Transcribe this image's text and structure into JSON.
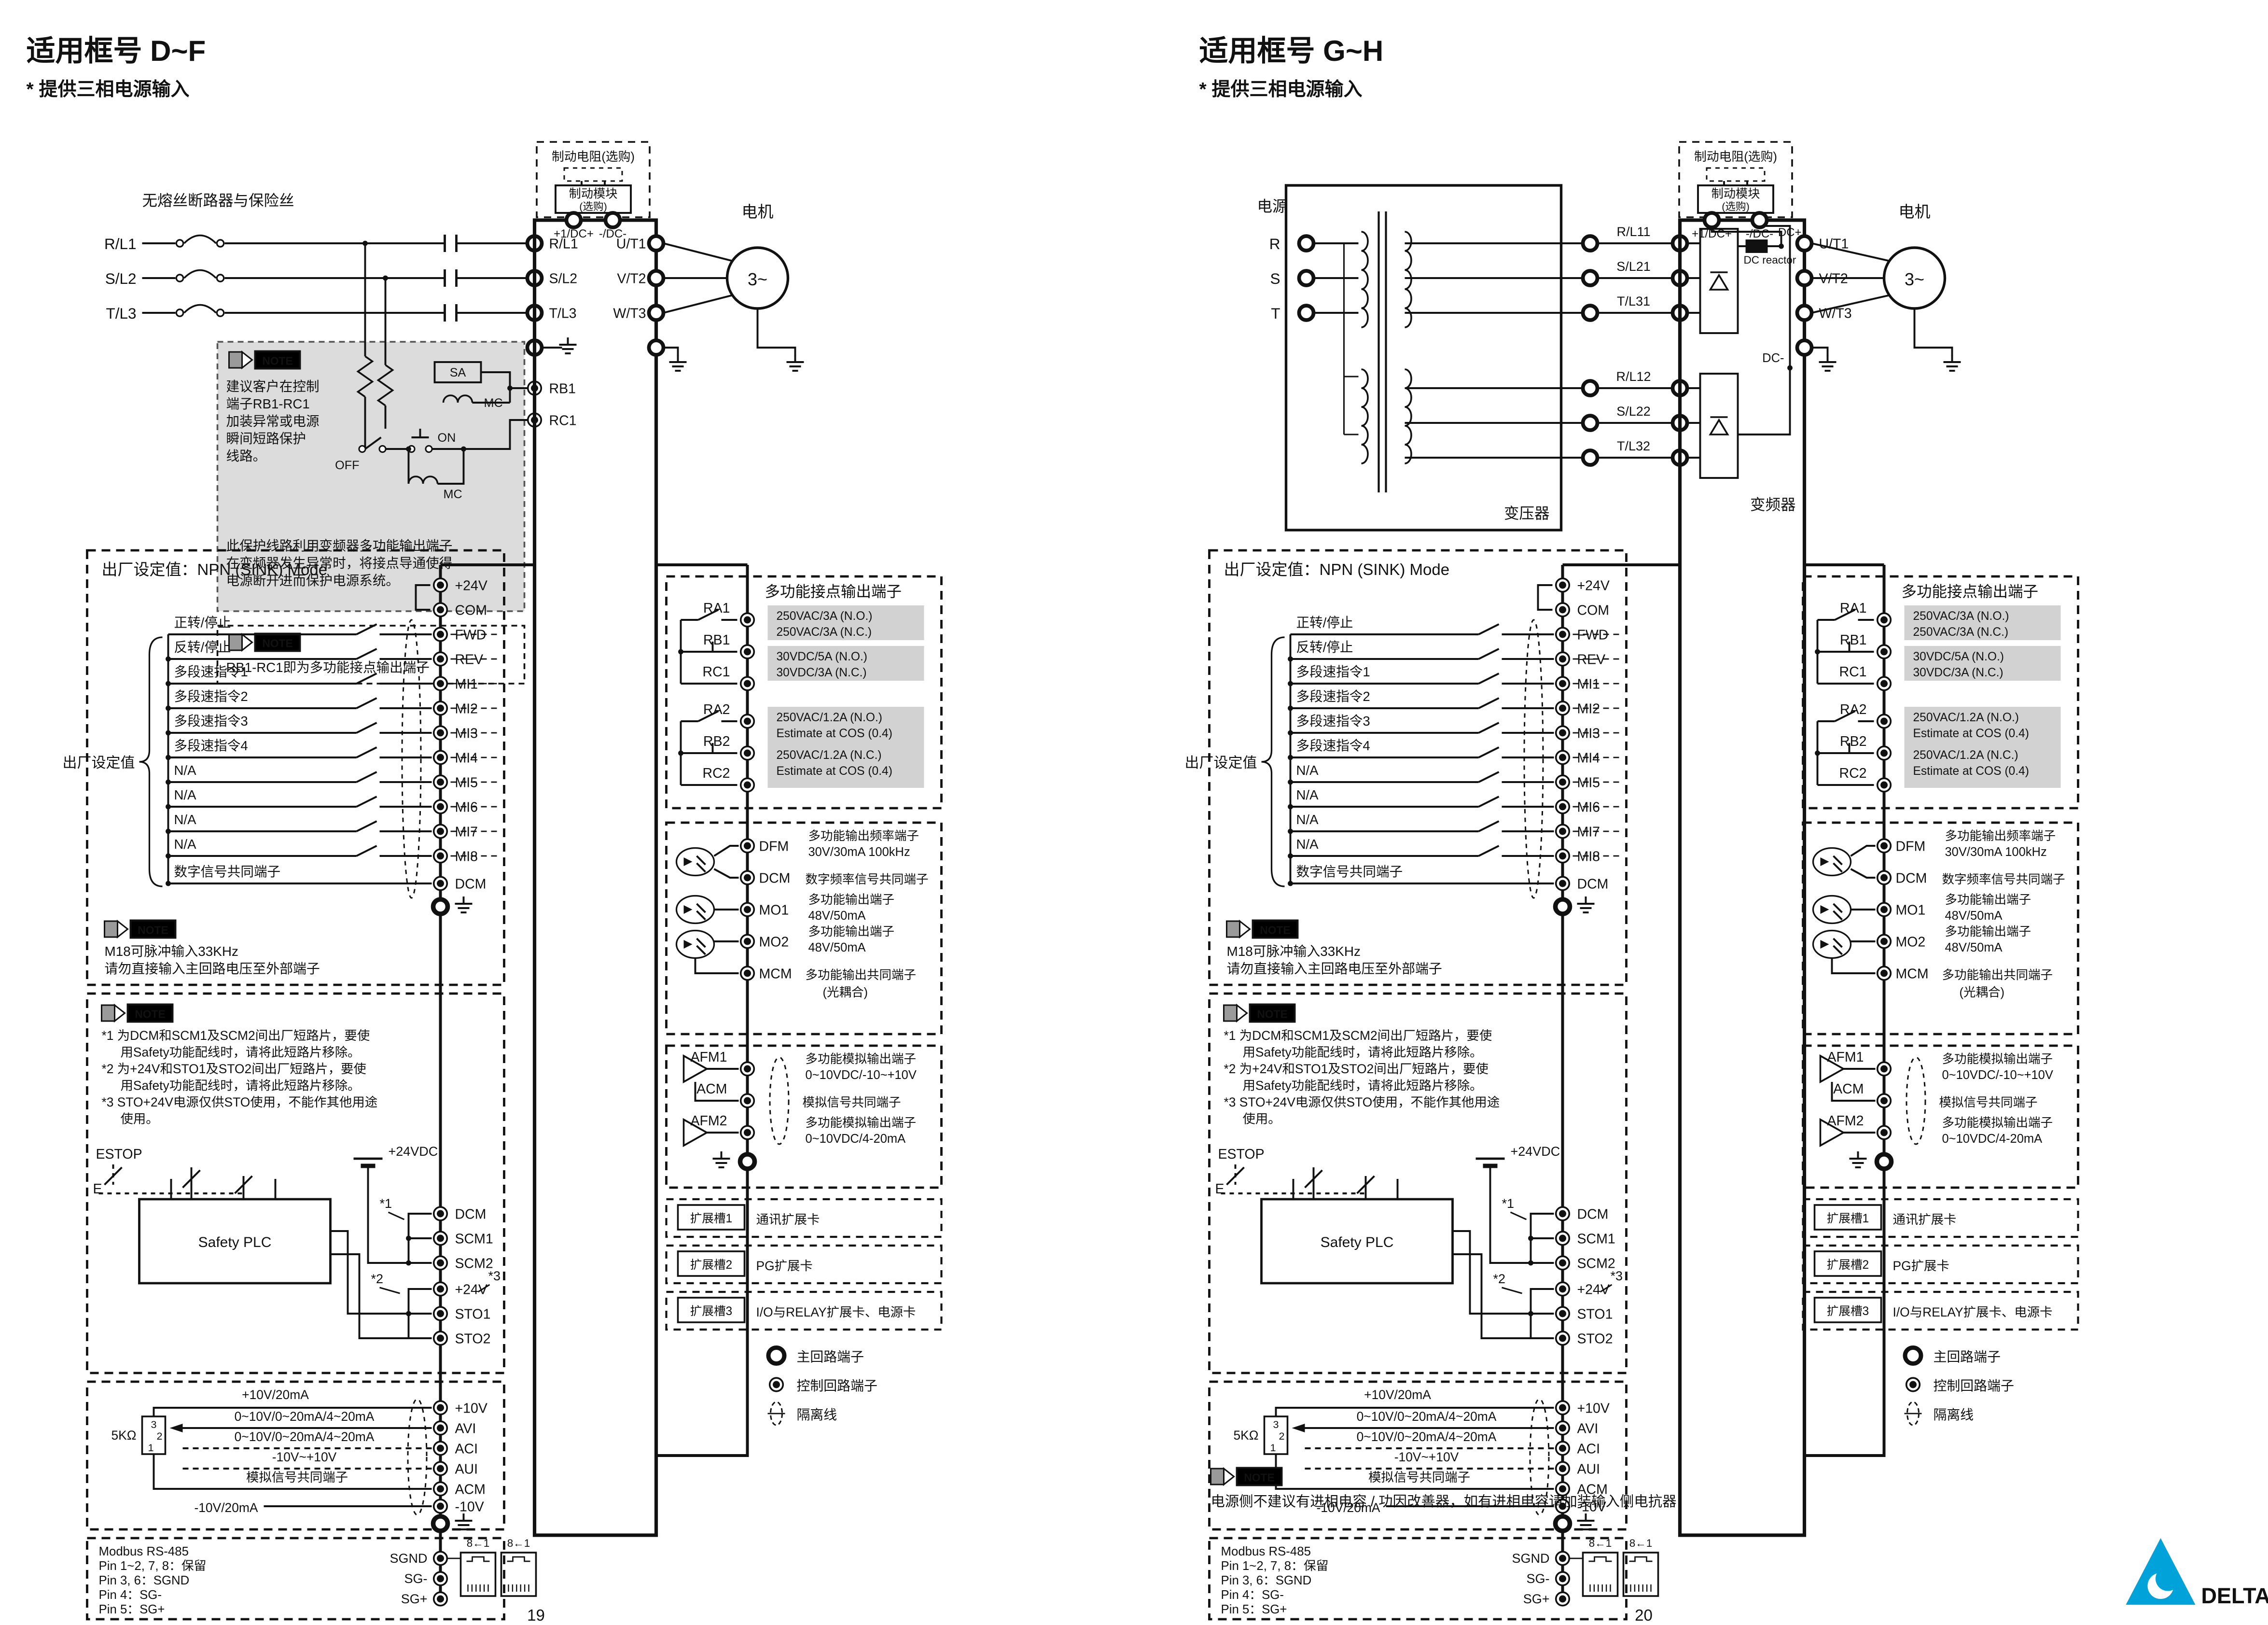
{
  "shared": {
    "note_label": "NOTE",
    "brake_resistor": "制动电阻(选购)",
    "brake_module": "制动模块",
    "optional": "(选购)",
    "dc_plus_term": "+1/DC+",
    "dc_minus_term": "-/DC-",
    "motor_label": "电机",
    "motor_text": "3~",
    "output_terms": [
      "U/T1",
      "V/T2",
      "W/T3"
    ],
    "sink_mode_title": "出厂设定值：NPN (SINK) Mode",
    "factory_default": "出厂设定值",
    "plus24v_term": "+24V",
    "com_term": "COM",
    "di": [
      {
        "term": "FWD",
        "func": "正转/停止"
      },
      {
        "term": "REV",
        "func": "反转/停止"
      },
      {
        "term": "MI1",
        "func": "多段速指令1"
      },
      {
        "term": "MI2",
        "func": "多段速指令2"
      },
      {
        "term": "MI3",
        "func": "多段速指令3"
      },
      {
        "term": "MI4",
        "func": "多段速指令4"
      },
      {
        "term": "MI5",
        "func": "N/A"
      },
      {
        "term": "MI6",
        "func": "N/A"
      },
      {
        "term": "MI7",
        "func": "N/A"
      },
      {
        "term": "MI8",
        "func": "N/A"
      },
      {
        "term": "DCM",
        "func": "数字信号共同端子"
      }
    ],
    "note_m18": [
      "M18可脉冲输入33KHz",
      "请勿直接输入主回路电压至外部端子"
    ],
    "relay_title": "多功能接点输出端子",
    "relay1_terms": [
      "RA1",
      "RB1",
      "RC1"
    ],
    "relay2_terms": [
      "RA2",
      "RB2",
      "RC2"
    ],
    "relay1_ratings": [
      "250VAC/3A (N.O.)",
      "250VAC/3A (N.C.)",
      "30VDC/5A (N.O.)",
      "30VDC/3A (N.C.)"
    ],
    "relay2_ratings": [
      "250VAC/1.2A (N.O.)",
      "Estimate at COS (0.4)",
      "250VAC/1.2A (N.C.)",
      "Estimate at COS (0.4)"
    ],
    "safety_note_lines": [
      "*1 为DCM和SCM1及SCM2间出厂短路片，要使",
      "用Safety功能配线时，请将此短路片移除。",
      "*2 为+24V和STO1及STO2间出厂短路片，要使",
      "用Safety功能配线时，请将此短路片移除。",
      "*3 STO+24V电源仅供STO使用，不能作其他用途",
      "使用。"
    ],
    "estop": "ESTOP",
    "e_label": "E",
    "safety_plc": "Safety PLC",
    "vdc24": "+24VDC",
    "sto_terms": [
      "DCM",
      "SCM1",
      "SCM2",
      "+24V",
      "STO1",
      "STO2"
    ],
    "star1": "*1",
    "star2": "*2",
    "star3": "*3",
    "mf_out": [
      {
        "term": "DFM",
        "d1": "多功能输出频率端子",
        "d2": "30V/30mA 100kHz"
      },
      {
        "term": "DCM",
        "d1": "数字频率信号共同端子",
        "d2": ""
      },
      {
        "term": "MO1",
        "d1": "多功能输出端子",
        "d2": "48V/50mA"
      },
      {
        "term": "MO2",
        "d1": "多功能输出端子",
        "d2": "48V/50mA"
      },
      {
        "term": "MCM",
        "d1": "多功能输出共同端子",
        "d2": "(光耦合)"
      }
    ],
    "afm": [
      {
        "term": "AFM1",
        "d1": "多功能模拟输出端子",
        "d2": "0~10VDC/-10~+10V"
      },
      {
        "term": "ACM",
        "d1": "模拟信号共同端子",
        "d2": ""
      },
      {
        "term": "AFM2",
        "d1": "多功能模拟输出端子",
        "d2": "0~10VDC/4-20mA"
      }
    ],
    "ai": [
      {
        "term": "+10V",
        "sig": "+10V/20mA"
      },
      {
        "term": "AVI",
        "sig": "0~10V/0~20mA/4~20mA"
      },
      {
        "term": "ACI",
        "sig": "0~10V/0~20mA/4~20mA"
      },
      {
        "term": "AUI",
        "sig": "-10V~+10V"
      },
      {
        "term": "ACM",
        "sig": "模拟信号共同端子"
      },
      {
        "term": "-10V",
        "sig": "-10V/20mA"
      }
    ],
    "pot_label": "5KΩ",
    "pot_pins": [
      "3",
      "2",
      "1"
    ],
    "slots": [
      {
        "name": "扩展槽1",
        "card": "通讯扩展卡"
      },
      {
        "name": "扩展槽2",
        "card": "PG扩展卡"
      },
      {
        "name": "扩展槽3",
        "card": "I/O与RELAY扩展卡、电源卡"
      }
    ],
    "legend": [
      "主回路端子",
      "控制回路端子",
      "隔离线"
    ],
    "modbus_lines": [
      "Modbus RS-485",
      "Pin 1~2, 7, 8：保留",
      "Pin 3, 6：SGND",
      "Pin 4：SG-",
      "Pin 5：SG+"
    ],
    "sg_terms": [
      "SGND",
      "SG-",
      "SG+"
    ],
    "rj45_label": "8←1"
  },
  "page_left": {
    "page_number": "19",
    "title": "适用框号 D~F",
    "subtitle": "* 提供三相电源输入",
    "breaker_label": "无熔丝断路器与保险丝",
    "phases": [
      "R/L1",
      "S/L2",
      "T/L3"
    ],
    "rb_terms": [
      "RB1",
      "RC1"
    ],
    "protect_note_lines": [
      "建议客户在控制",
      "端子RB1-RC1",
      "加装异常或电源",
      "瞬间短路保护",
      "线路。",
      "此保护线路利用变频器多功能输出端子",
      "在变频器发生异常时，将接点导通使得",
      "电源断开进而保护电源系统。"
    ],
    "rb_note": "RB1-RC1即为多功能接点输出端子",
    "sa_label": "SA",
    "mc_label": "MC",
    "on_label": "ON",
    "off_label": "OFF"
  },
  "page_right": {
    "page_number": "20",
    "title": "适用框号 G~H",
    "subtitle": "* 提供三相电源输入",
    "power_label": "电源",
    "phases": [
      "R",
      "S",
      "T"
    ],
    "transformer_label": "变压器",
    "inverter_label": "变频器",
    "input_group1": [
      "R/L11",
      "S/L21",
      "T/L31"
    ],
    "input_group2": [
      "R/L12",
      "S/L22",
      "T/L32"
    ],
    "dc_plus": "DC+",
    "dc_reactor": "DC reactor",
    "dc_minus": "DC-",
    "bottom_note": "电源侧不建议有进相电容 / 功因改善器，如有进相电容请加装输入侧电抗器"
  },
  "footer": {
    "brand": "DELTA",
    "page_numbers": [
      "19",
      "20"
    ],
    "brand_color": "#00a3d9"
  }
}
